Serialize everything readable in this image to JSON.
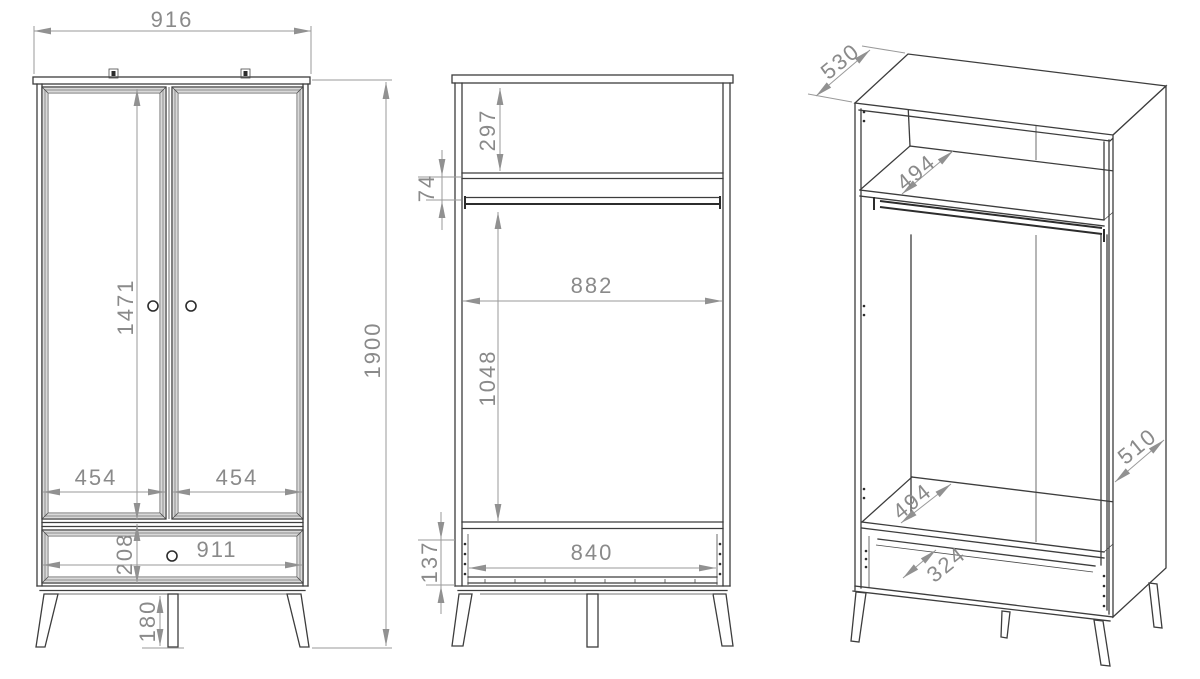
{
  "views": {
    "front": {
      "label": "front-elevation",
      "dims": {
        "overall_width": "916",
        "overall_height": "1900",
        "door_height": "1471",
        "left_door_width": "454",
        "right_door_width": "454",
        "drawer_front_height": "208",
        "drawer_width": "911",
        "leg_height": "180"
      }
    },
    "section": {
      "label": "front-section",
      "dims": {
        "top_compartment_height": "297",
        "rail_zone_height": "74",
        "interior_width": "882",
        "hanging_space_height": "1048",
        "drawer_box_height": "137",
        "drawer_interior_width": "840"
      }
    },
    "isometric": {
      "label": "isometric-open-carcass",
      "dims": {
        "top_depth": "530",
        "shelf_depth": "494",
        "side_panel_depth": "510",
        "bottom_shelf_depth": "494",
        "drawer_interior_depth": "324"
      }
    }
  },
  "colors": {
    "line": "#3d3d3d",
    "dimension": "#8a8a8a",
    "background": "#ffffff"
  }
}
